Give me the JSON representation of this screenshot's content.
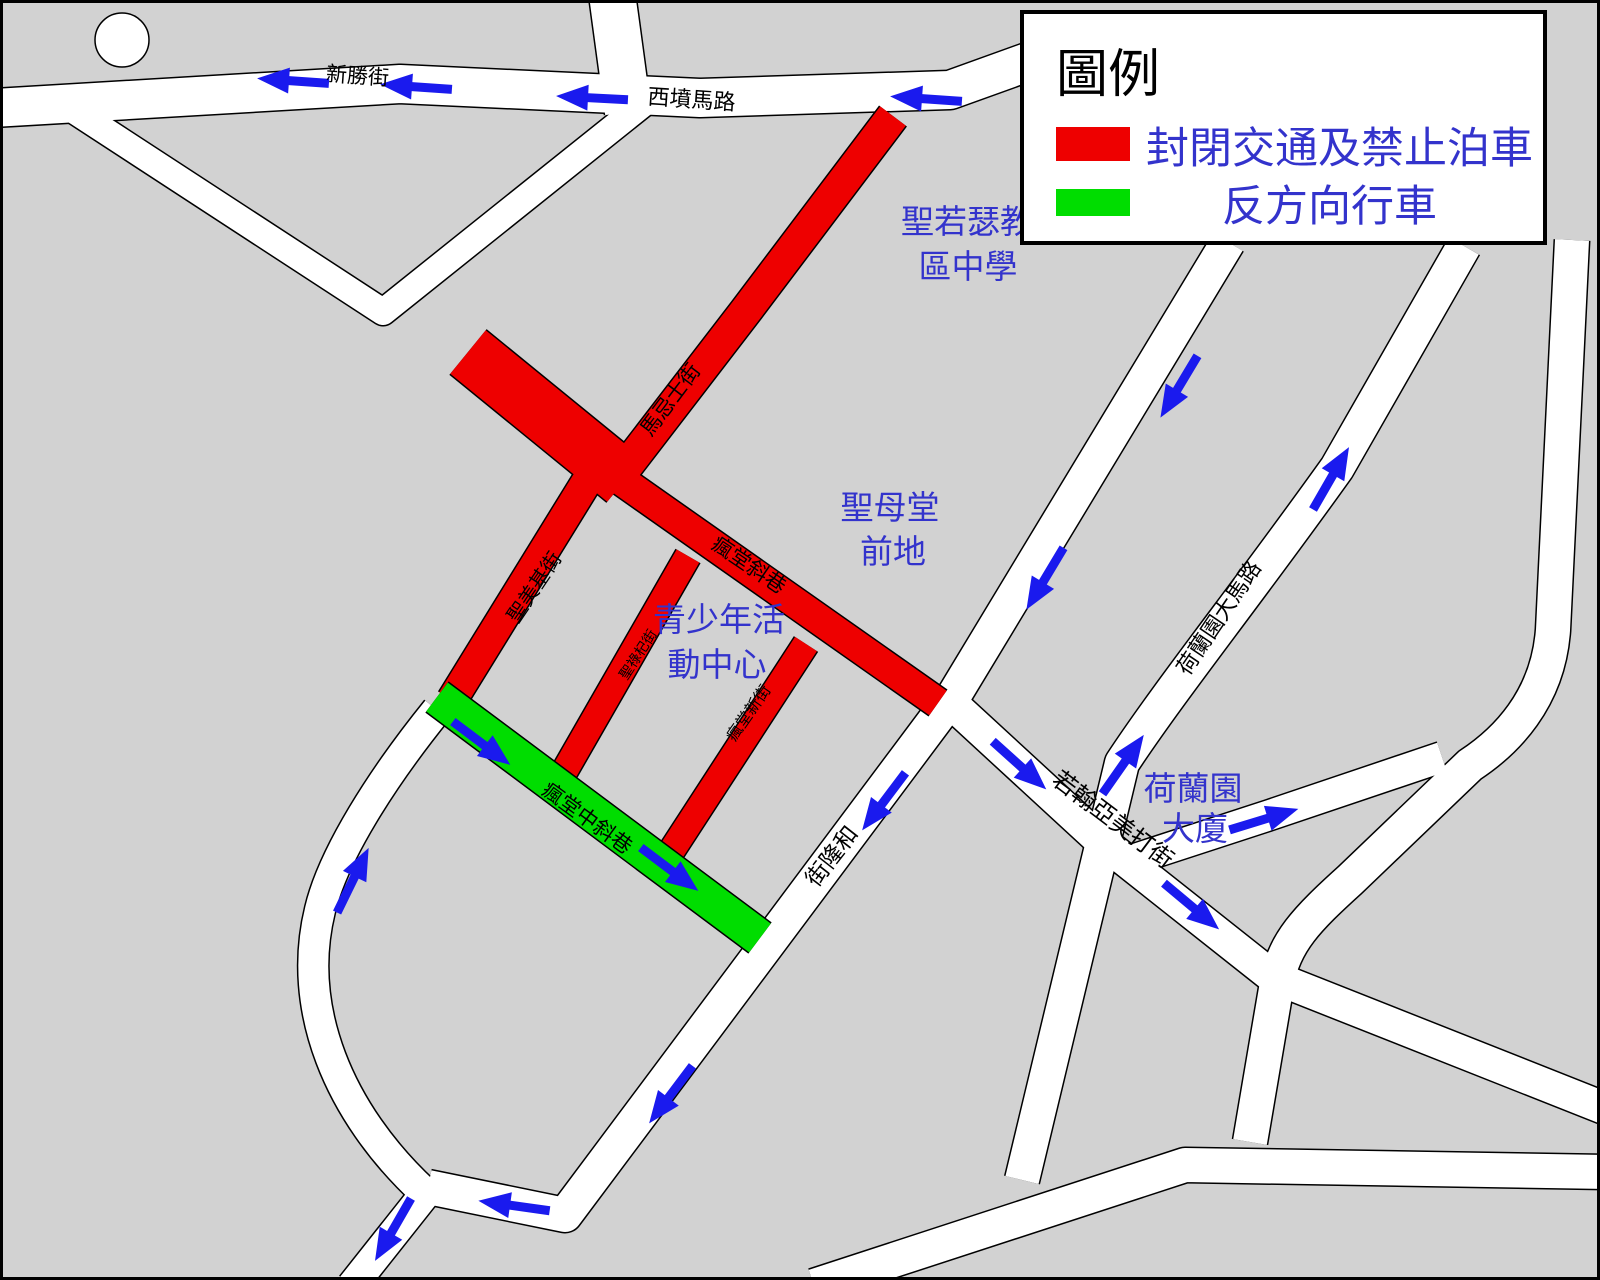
{
  "legend": {
    "title": "圖例",
    "items": [
      {
        "color": "#ee0000",
        "label": "封閉交通及禁止泊車"
      },
      {
        "color": "#00dd00",
        "label": "反方向行車"
      }
    ]
  },
  "streets": {
    "san_seng_kai": "新勝街",
    "sai_fan_ma_lou": "西墳馬路",
    "ma_kei_si_kai": "馬忌士街",
    "seng_mei_kei_kai": "聖美基街",
    "fong_tong_che_hong": "瘋堂斜巷",
    "seng_lok_kei_kai": "聖祿杞街",
    "fong_tong_san_kai": "瘋堂新街",
    "fong_tong_chong_che_hong": "瘋堂中斜巷",
    "wo_long_kai": "和隆街",
    "ho_lan_un_tai_ma_lou": "荷蘭園大馬路",
    "ieok_hon_a_mei_ta_kai": "若翰亞美打街"
  },
  "places": {
    "school": {
      "line1": "聖若瑟教",
      "line2": "區中學"
    },
    "church_square": {
      "line1": "聖母堂",
      "line2": "前地"
    },
    "youth_center": {
      "line1": "青少年活",
      "line2": "動中心"
    },
    "building": {
      "line1": "荷蘭園",
      "line2": "大廈"
    }
  },
  "colors": {
    "closed_road": "#ee0000",
    "reverse_flow": "#00dd00",
    "arrow": "#1a1aee",
    "label_blue": "#3333cc",
    "block_gray": "#d2d2d2",
    "road_white": "#ffffff"
  }
}
